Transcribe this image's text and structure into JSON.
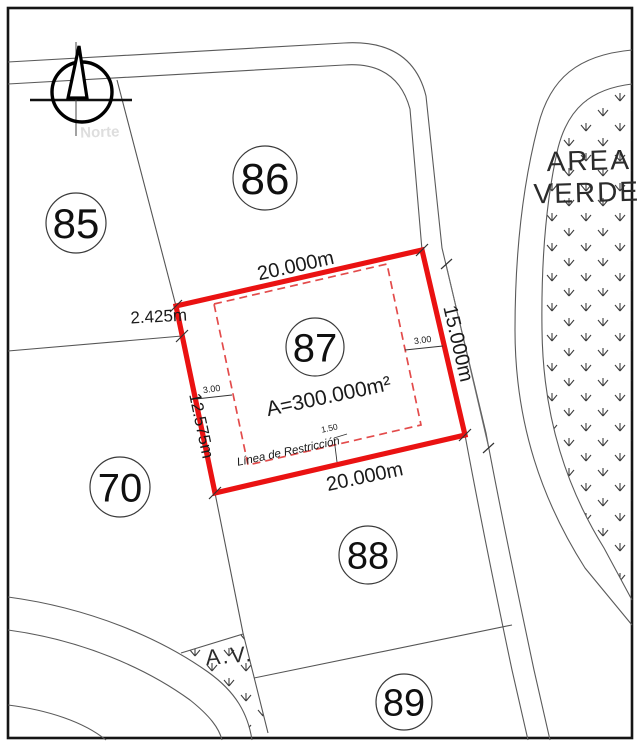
{
  "drawing": {
    "north_watermark": "Norte",
    "green_area": {
      "line1": "AREA",
      "line2": "VERDE"
    },
    "small_green_area_label": "A.V.",
    "lots": {
      "lot85": "85",
      "lot86": "86",
      "lot87": "87",
      "lot70": "70",
      "lot88": "88",
      "lot89": "89"
    },
    "lot87_details": {
      "area": "A=300.000m²",
      "dim_top": "20.000m",
      "dim_bottom": "20.000m",
      "dim_right": "15.000m",
      "dim_left_lower": "12.575m",
      "dim_left_upper": "2.425m",
      "setback_left": "3.00",
      "setback_right": "3.00",
      "setback_bottom": "1.50",
      "restriction_line": "Línea de Restricción"
    },
    "colors": {
      "lot_outline": "#ea1212",
      "restriction_dashed": "#e34b4b",
      "thin_line": "#5a5a5a",
      "frame": "#151515"
    }
  }
}
